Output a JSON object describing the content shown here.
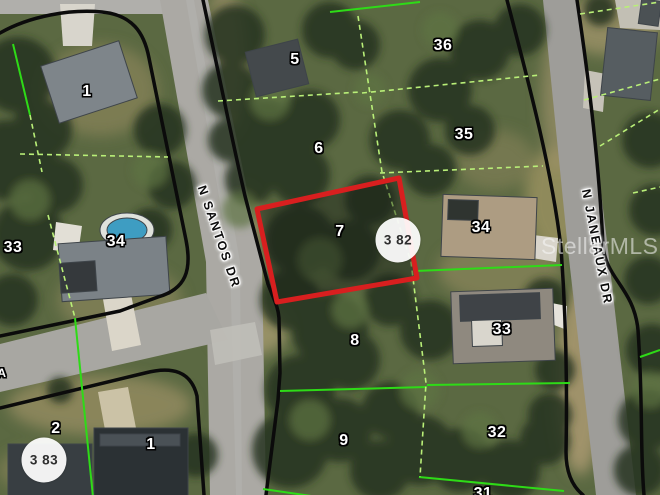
{
  "image_type": "aerial-parcel-map",
  "watermark": "StellarMLS",
  "streets": [
    {
      "name": "N SANTOS DR"
    },
    {
      "name": "N JANEAUX DR"
    }
  ],
  "highlight": {
    "lot": "7",
    "border_color": "#d81f1f"
  },
  "line_colors": {
    "block_boundary": "#0b0b0b",
    "lot_boundary_solid": "#2edb17",
    "lot_boundary_dashed": "#b9ef78"
  },
  "markers": [
    {
      "label": "3 83"
    },
    {
      "label": "3 82"
    }
  ],
  "lots": [
    {
      "key": "lot-1-nw",
      "label": "1"
    },
    {
      "key": "lot-5",
      "label": "5"
    },
    {
      "key": "lot-36",
      "label": "36"
    },
    {
      "key": "lot-6",
      "label": "6"
    },
    {
      "key": "lot-35",
      "label": "35"
    },
    {
      "key": "lot-7",
      "label": "7"
    },
    {
      "key": "lot-34-west",
      "label": "34"
    },
    {
      "key": "lot-33-west-edge",
      "label": "33"
    },
    {
      "key": "lot-34-east",
      "label": "34"
    },
    {
      "key": "lot-33-east",
      "label": "33"
    },
    {
      "key": "lot-8",
      "label": "8"
    },
    {
      "key": "lot-2",
      "label": "2"
    },
    {
      "key": "lot-1-south",
      "label": "1"
    },
    {
      "key": "lot-9",
      "label": "9"
    },
    {
      "key": "lot-32",
      "label": "32"
    },
    {
      "key": "lot-31-partial",
      "label": "31"
    },
    {
      "key": "edge-partial",
      "label": "A"
    }
  ]
}
